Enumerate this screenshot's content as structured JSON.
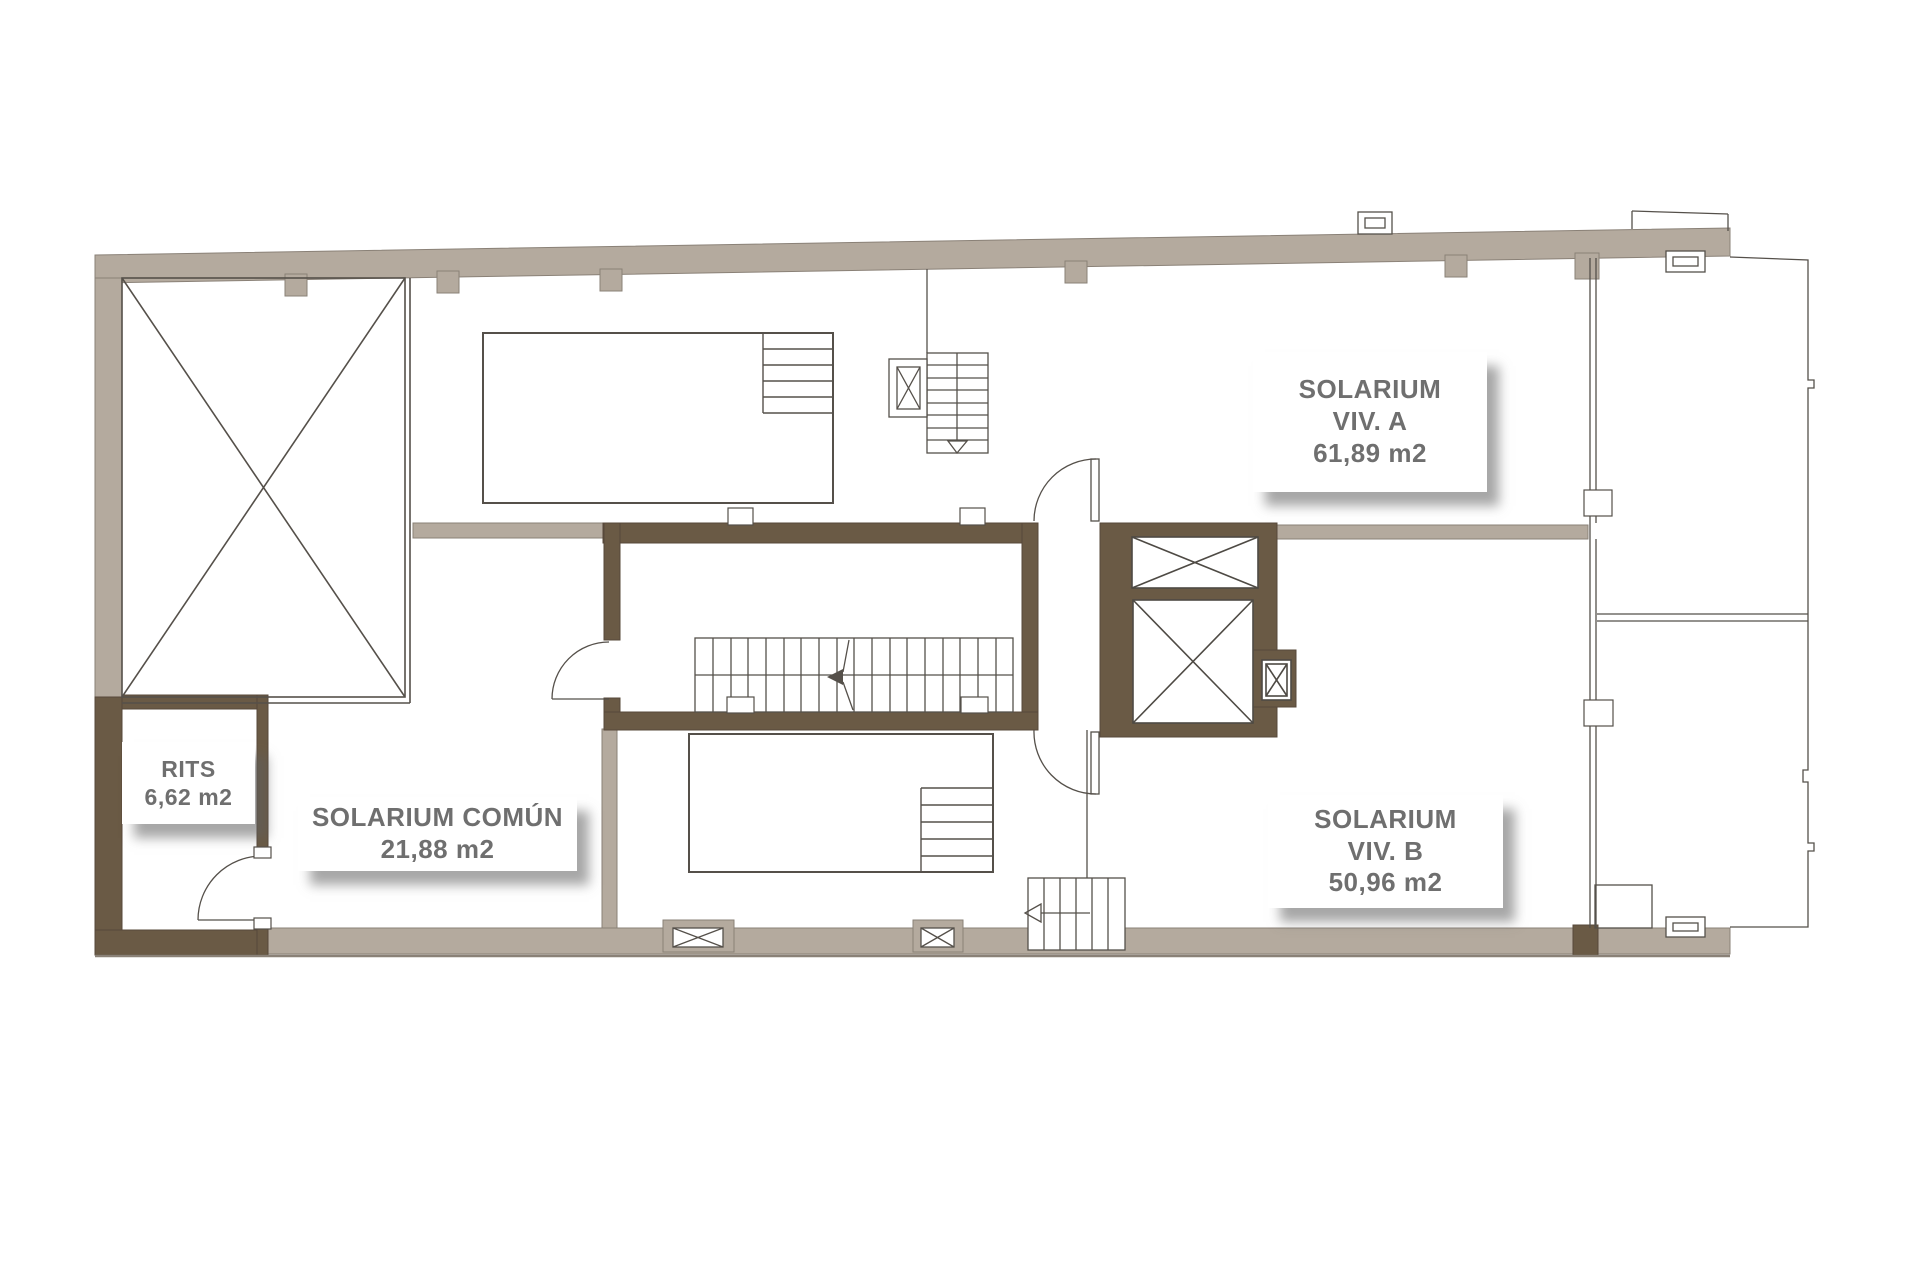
{
  "plan": {
    "type": "architectural-floor-plan",
    "level": "solarium-roof-level"
  },
  "rooms": {
    "solarium_a": {
      "name": "SOLARIUM",
      "unit": "VIV. A",
      "area": "61,89 m2"
    },
    "solarium_b": {
      "name": "SOLARIUM",
      "unit": "VIV. B",
      "area": "50,96 m2"
    },
    "solarium_comun": {
      "name": "SOLARIUM COMÚN",
      "area": "21,88 m2"
    },
    "rits": {
      "name": "RITS",
      "area": "6,62 m2"
    }
  },
  "colors": {
    "background": "#ffffff",
    "wall_light": "#b4aa9e",
    "wall_light_edge": "#8a8177",
    "wall_dark": "#6a5a45",
    "thin_line": "#4e4a44",
    "label_text": "#6f6f6f",
    "card_background": "#ffffff",
    "card_shadow": "#5f5f5f"
  }
}
